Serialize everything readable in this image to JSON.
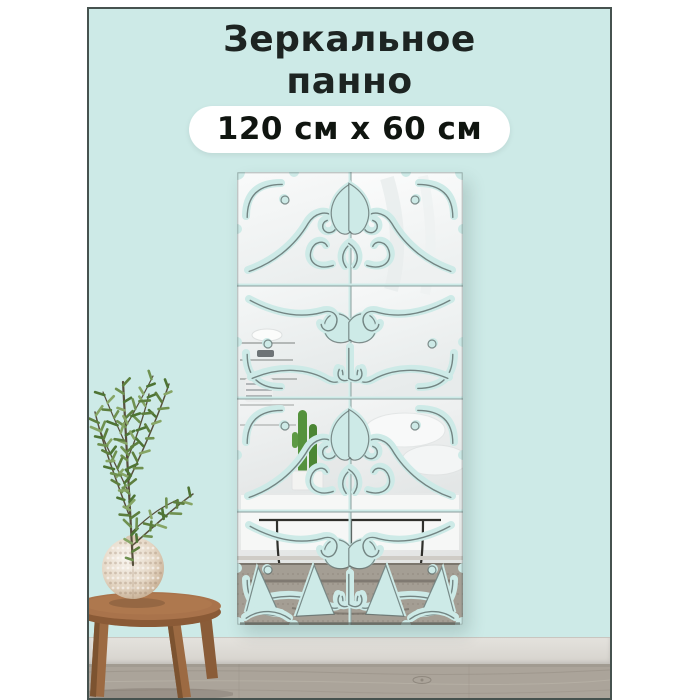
{
  "card": {
    "title_line1": "Зеркальное",
    "title_line2": "панно",
    "size_badge": "120 см x 60 см"
  },
  "colors": {
    "page_bg": "#ffffff",
    "wall": "#cdeae7",
    "frame_border": "#46524f",
    "title_text": "#1d2422",
    "badge_bg": "#ffffff",
    "badge_text": "#101510",
    "baseboard": "#e4e2dd",
    "floor": "#aba49a",
    "stool_wood": "#a9734b",
    "plant_green": "#5d7f3e",
    "mirror_shade": "#e3e6e6"
  }
}
